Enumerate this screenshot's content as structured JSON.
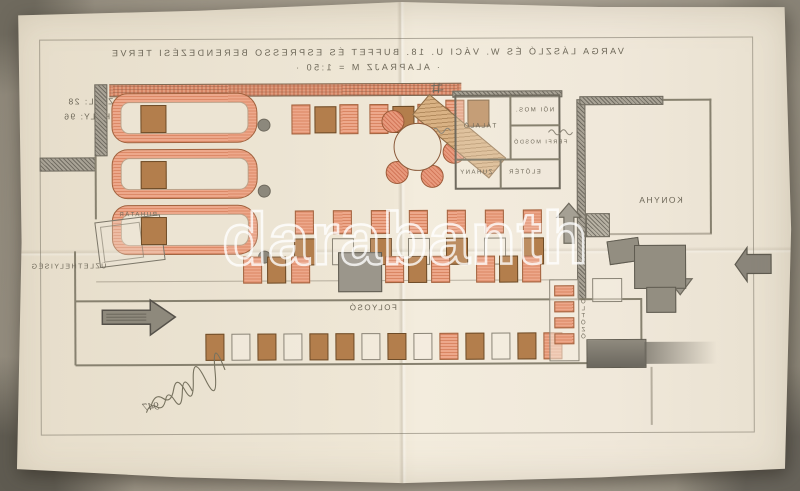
{
  "watermark": {
    "text": "darabanth"
  },
  "title": {
    "line1": "VARGA LÁSZLÓ ÉS W. VÁCI U. 18. BUFFET ÉS ESPRESSO BERENDEZÉSI TERVE",
    "line2": "· ALAPRAJZ  M = 1:50 ·"
  },
  "stats": {
    "tables": "ASZTAL: 28",
    "seats": "ÜLŐHELY: 96"
  },
  "labels": {
    "talalo": "TÁLALÓ",
    "noi_mosdo": "NŐI MOS.",
    "ferfi_mosdo": "FÉRFI MOSDÓ",
    "zuhany": "ZUHANY",
    "eloter": "ELŐTÉR",
    "konyha": "KONYHA",
    "folyoso": "FOLYOSÓ",
    "uzlethelyiseg": "ÜZLETHELYISÉG",
    "ruhatar": "RUHATÁR",
    "oltozo": "ÖLTÖZŐ"
  },
  "signature": {
    "year": "947"
  },
  "colors": {
    "paper": "#efe7d6",
    "backdrop": "#a59d8e",
    "pencil": "#6f6a5e",
    "banquette_salmon": "#eda88b",
    "table_brown": "#b37e4c",
    "wall_red_hatch": "#e29c7d",
    "shade_gray": "#938e81",
    "watermark_stroke": "#ffffff"
  }
}
